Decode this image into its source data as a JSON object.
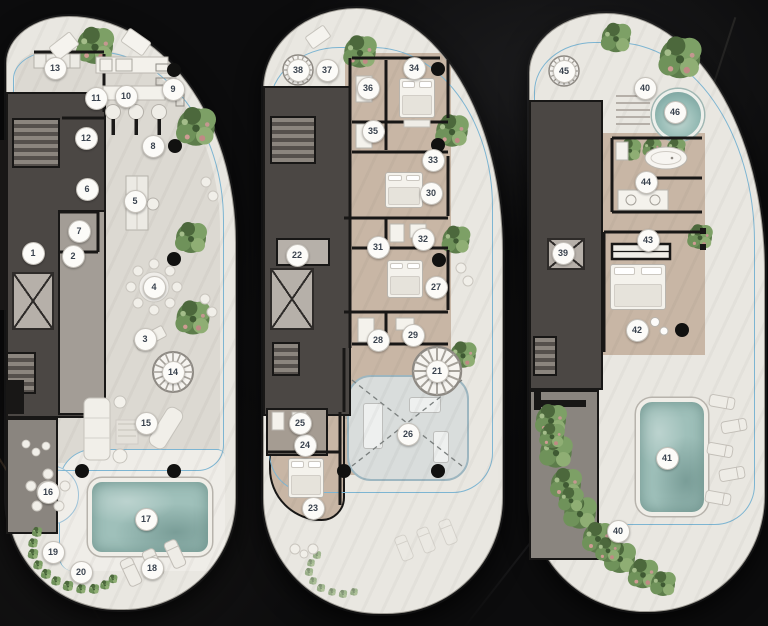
{
  "palette": {
    "marble_bg": "#0c0c0d",
    "pod_fill": "#e9e7e1",
    "pod_edge": "#9f9c95",
    "floor_light": "#dcd9d2",
    "floor_tan": "#c8b6a5",
    "core_dark": "#4b4744",
    "core_mid": "#a39d96",
    "wall_black": "#181716",
    "facade_blue": "#7db5d2",
    "pool_teal": "#9fc0ba",
    "plant_green": "#5d7d4b",
    "marker_bg": "#fcfbf8",
    "marker_text": "#39424e"
  },
  "plans": [
    {
      "name": "plan-left",
      "markers": [
        {
          "n": "1",
          "x": 33,
          "y": 253
        },
        {
          "n": "2",
          "x": 73,
          "y": 256
        },
        {
          "n": "3",
          "x": 145,
          "y": 339
        },
        {
          "n": "4",
          "x": 154,
          "y": 287
        },
        {
          "n": "5",
          "x": 135,
          "y": 201
        },
        {
          "n": "6",
          "x": 87,
          "y": 189
        },
        {
          "n": "7",
          "x": 79,
          "y": 231
        },
        {
          "n": "8",
          "x": 153,
          "y": 146
        },
        {
          "n": "9",
          "x": 173,
          "y": 89
        },
        {
          "n": "10",
          "x": 126,
          "y": 96
        },
        {
          "n": "11",
          "x": 96,
          "y": 98
        },
        {
          "n": "12",
          "x": 86,
          "y": 138
        },
        {
          "n": "13",
          "x": 55,
          "y": 68
        },
        {
          "n": "14",
          "x": 173,
          "y": 372
        },
        {
          "n": "15",
          "x": 146,
          "y": 423
        },
        {
          "n": "16",
          "x": 48,
          "y": 492
        },
        {
          "n": "17",
          "x": 146,
          "y": 519
        },
        {
          "n": "18",
          "x": 152,
          "y": 568
        },
        {
          "n": "19",
          "x": 53,
          "y": 552
        },
        {
          "n": "20",
          "x": 81,
          "y": 572
        }
      ]
    },
    {
      "name": "plan-middle",
      "markers": [
        {
          "n": "21",
          "x": 437,
          "y": 371
        },
        {
          "n": "22",
          "x": 297,
          "y": 255
        },
        {
          "n": "23",
          "x": 313,
          "y": 508
        },
        {
          "n": "24",
          "x": 305,
          "y": 445
        },
        {
          "n": "25",
          "x": 300,
          "y": 423
        },
        {
          "n": "26",
          "x": 408,
          "y": 434
        },
        {
          "n": "27",
          "x": 436,
          "y": 287
        },
        {
          "n": "28",
          "x": 378,
          "y": 340
        },
        {
          "n": "29",
          "x": 413,
          "y": 335
        },
        {
          "n": "30",
          "x": 431,
          "y": 193
        },
        {
          "n": "31",
          "x": 378,
          "y": 247
        },
        {
          "n": "32",
          "x": 423,
          "y": 239
        },
        {
          "n": "33",
          "x": 433,
          "y": 160
        },
        {
          "n": "34",
          "x": 414,
          "y": 68
        },
        {
          "n": "35",
          "x": 373,
          "y": 131
        },
        {
          "n": "36",
          "x": 368,
          "y": 88
        },
        {
          "n": "37",
          "x": 327,
          "y": 70
        },
        {
          "n": "38",
          "x": 298,
          "y": 70
        }
      ]
    },
    {
      "name": "plan-right",
      "markers": [
        {
          "n": "39",
          "x": 563,
          "y": 253
        },
        {
          "n": "40",
          "x": 645,
          "y": 88
        },
        {
          "n": "41",
          "x": 667,
          "y": 458
        },
        {
          "n": "42",
          "x": 637,
          "y": 330
        },
        {
          "n": "43",
          "x": 648,
          "y": 240
        },
        {
          "n": "44",
          "x": 646,
          "y": 182
        },
        {
          "n": "45",
          "x": 564,
          "y": 71
        },
        {
          "n": "46",
          "x": 675,
          "y": 112
        },
        {
          "n": "40",
          "x": 618,
          "y": 531
        }
      ]
    }
  ]
}
